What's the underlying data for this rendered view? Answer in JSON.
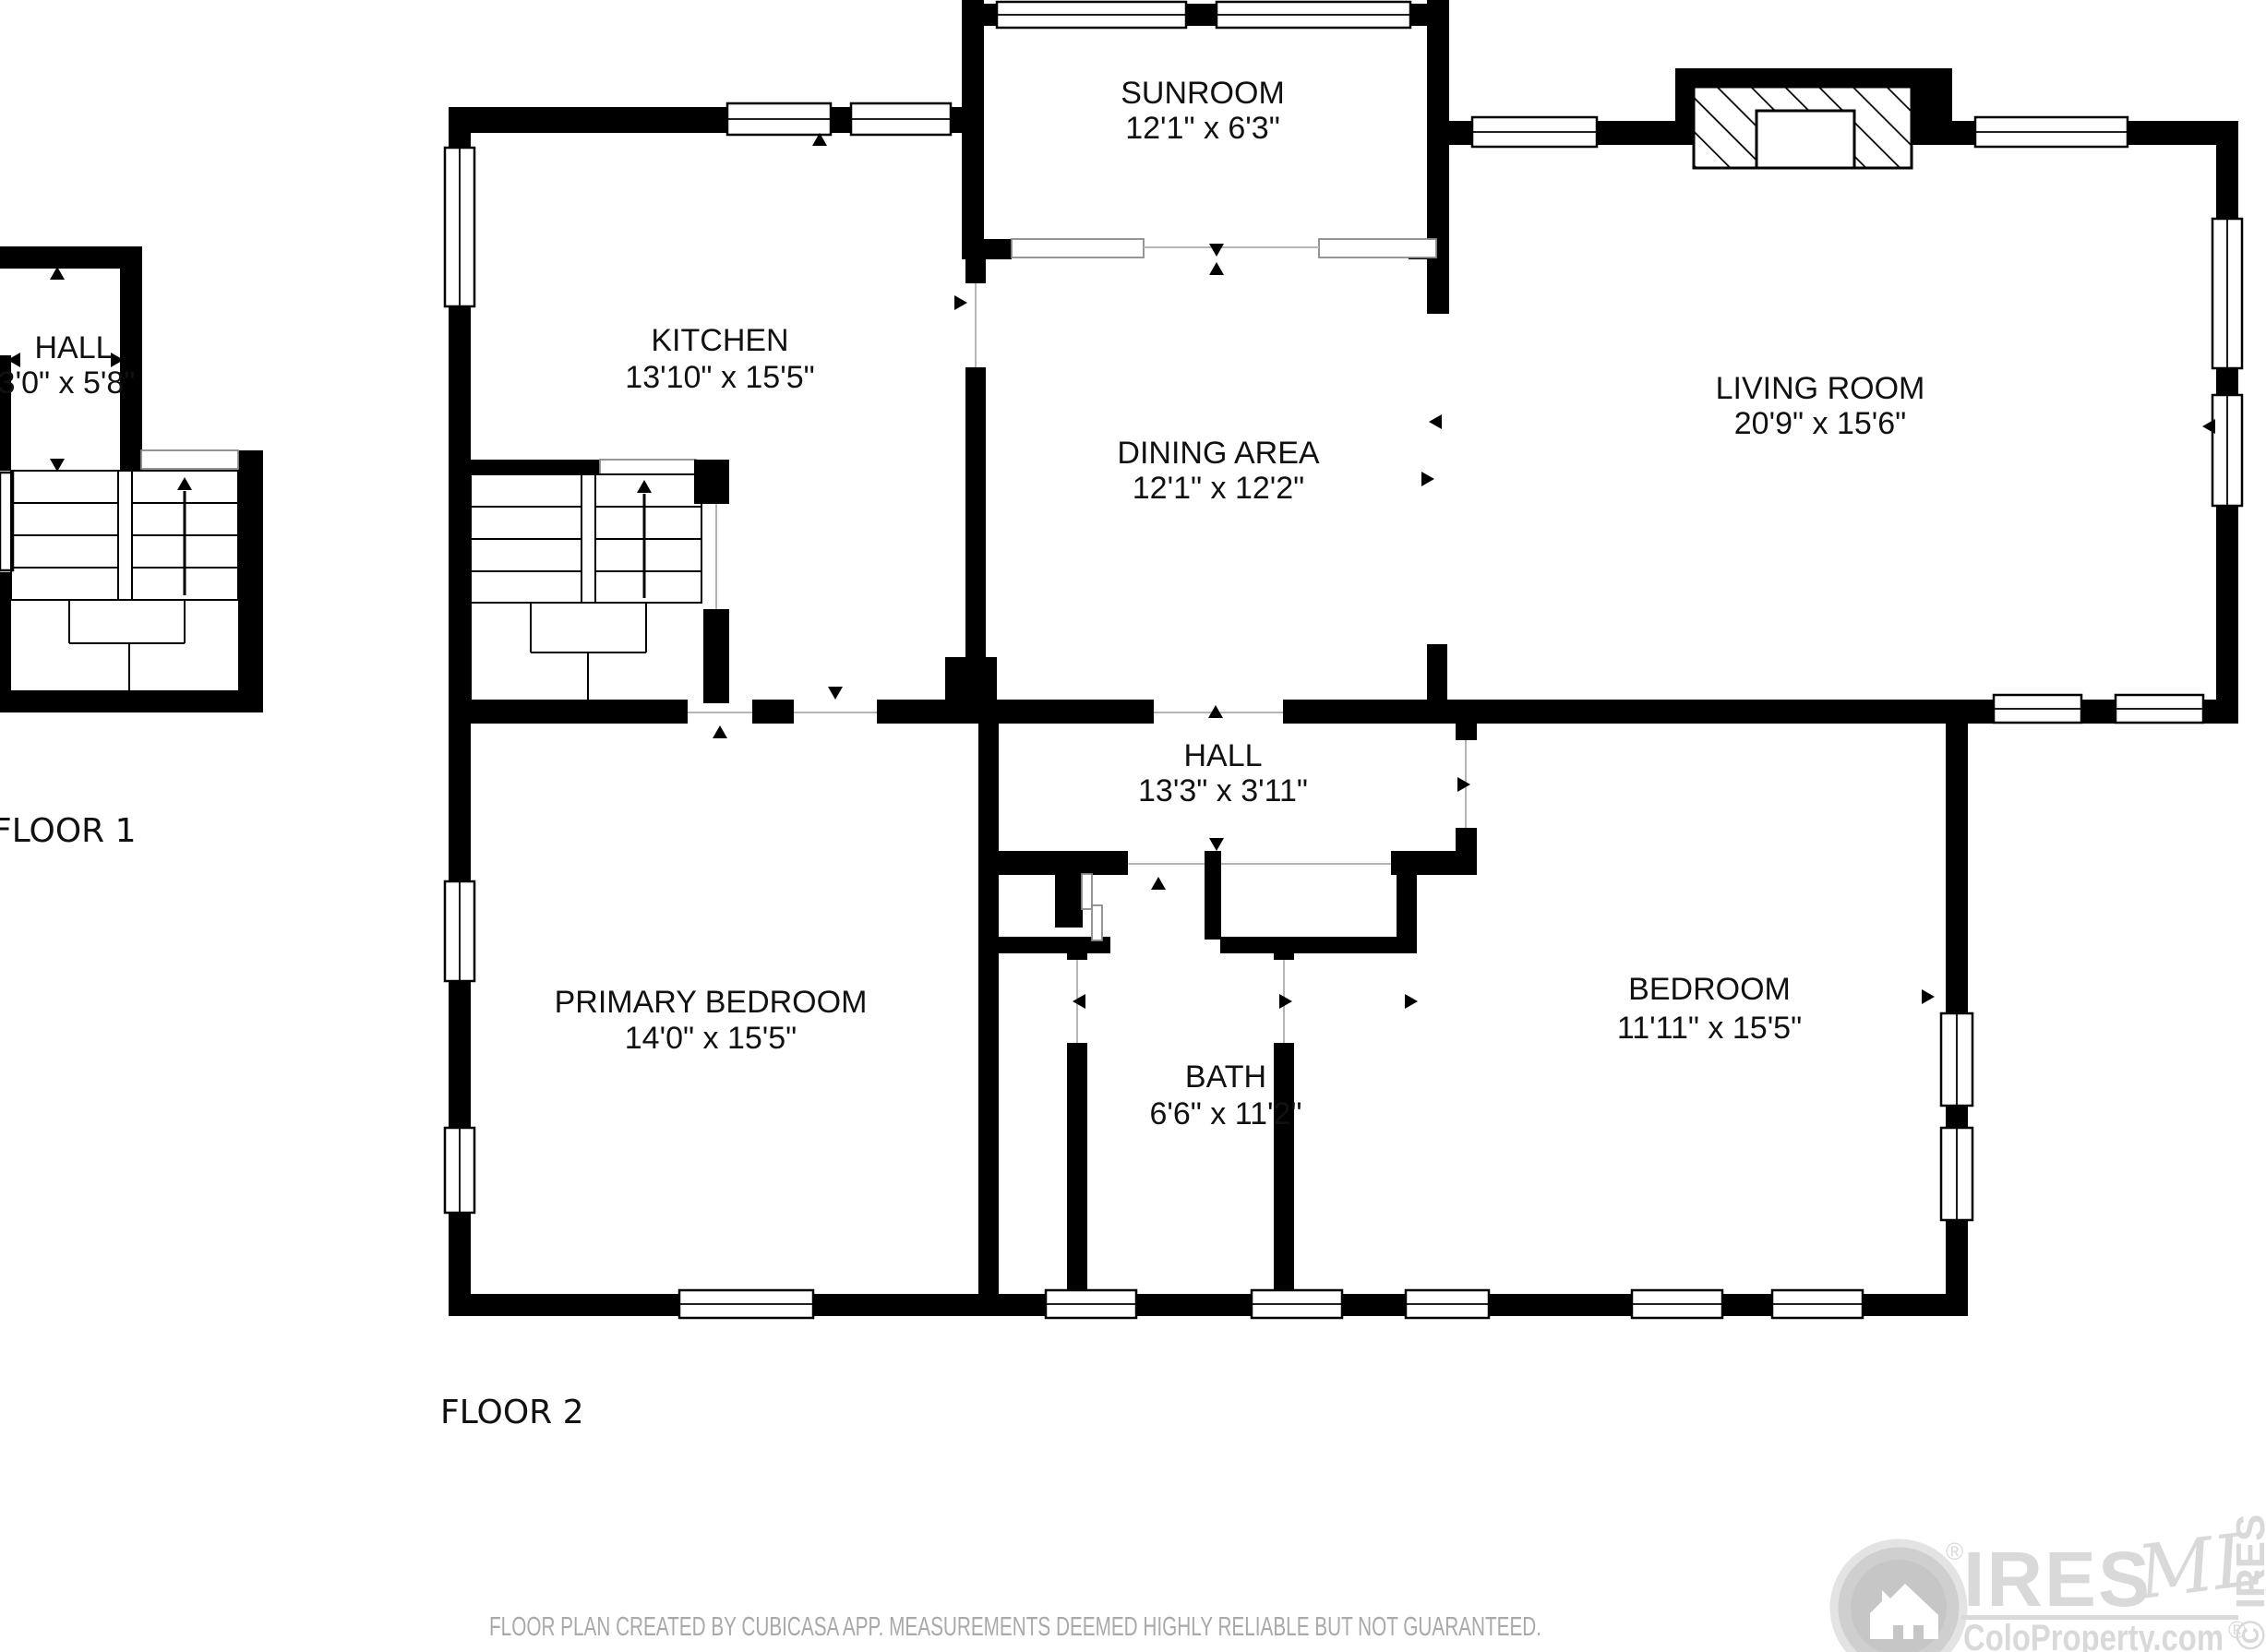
{
  "floors": [
    {
      "label": "FLOOR 1",
      "rooms": [
        {
          "name": "HALL",
          "dims": "3'0\" x 5'8\""
        }
      ]
    },
    {
      "label": "FLOOR 2",
      "rooms": [
        {
          "name": "SUNROOM",
          "dims": "12'1\" x 6'3\""
        },
        {
          "name": "KITCHEN",
          "dims": "13'10\" x 15'5\""
        },
        {
          "name": "DINING AREA",
          "dims": "12'1\" x 12'2\""
        },
        {
          "name": "LIVING ROOM",
          "dims": "20'9\" x 15'6\""
        },
        {
          "name": "HALL",
          "dims": "13'3\" x 3'11\""
        },
        {
          "name": "PRIMARY BEDROOM",
          "dims": "14'0\" x 15'5\""
        },
        {
          "name": "BATH",
          "dims": "6'6\" x 11'2\""
        },
        {
          "name": "BEDROOM",
          "dims": "11'11\" x 15'5\""
        }
      ]
    }
  ],
  "footer": {
    "disclaimer": "FLOOR PLAN CREATED BY CUBICASA APP. MEASUREMENTS DEEMED HIGHLY RELIABLE BUT NOT GUARANTEED."
  },
  "watermark": {
    "brand": "IRES",
    "mls": "MLS",
    "site": "ColoProperty.com",
    "reg": "®",
    "edge": "© IRES"
  },
  "colors": {
    "wall": "#000000",
    "watermark_gray": "#d9d9d9",
    "disclaimer_gray": "#a9a9a9"
  }
}
